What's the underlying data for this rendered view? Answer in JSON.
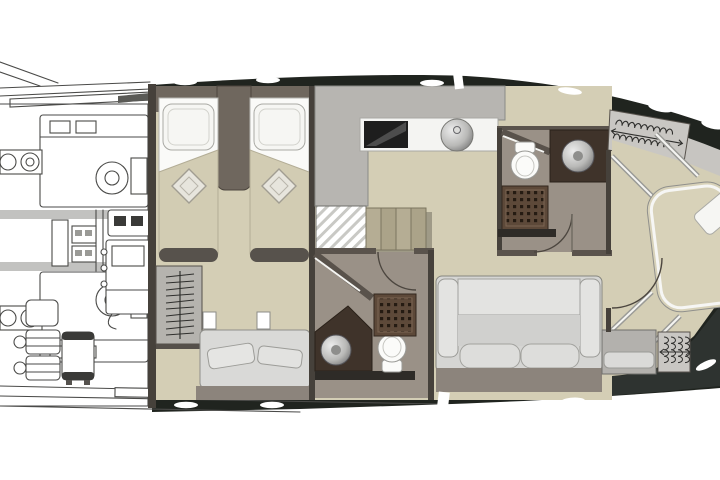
{
  "image_kind": "yacht-lower-deck-floor-plan",
  "visible_text": [],
  "colors": {
    "page_bg": "#ffffff",
    "hull_dark": "#20241f",
    "hull_bow": "#2e3330",
    "deck_gray": "#c7c5c1",
    "floor_beige": "#d4ceb5",
    "floor_bath": "#9a9187",
    "wall_dark": "#46413b",
    "wall_taupe": "#5a534c",
    "cabin_taupe": "#6f675e",
    "counter_gray": "#b7b5b1",
    "worktop_white": "#f4f4f2",
    "cooktop_black": "#1e1e1e",
    "vanity_brown": "#3f332a",
    "shower_brown": "#5d4939",
    "shower_dot": "#251b12",
    "blanket_beige": "#d2ccb3",
    "bed_frame_dark": "#57524c",
    "pillow_white": "#f6f6f3",
    "closet_gray": "#c9c7c3",
    "sofa_back": "#e3e3e1",
    "sofa_mid": "#d0d0ce",
    "sofa_seat": "#dddddb",
    "sofa_plinth": "#8c847c",
    "step_tan": "#b5ad94",
    "ink": "#4a4a48",
    "metal_light": "#ececec",
    "metal_dark": "#7e7e7e",
    "toilet_white": "#fbfbf9",
    "arc_ink": "#4c463f"
  },
  "rooms": [
    "engine-room",
    "twin-bed-cabin",
    "galley",
    "staircase",
    "mid-bathroom",
    "forward-bathroom",
    "salon-seating",
    "bow-cabin"
  ],
  "furniture_glyphs": [
    "engine-block",
    "generator",
    "battery-bank",
    "water-heater",
    "swim-platform",
    "twin-bed",
    "pillow",
    "diamond-cushion",
    "hanging-locker",
    "settee",
    "stairs",
    "cooktop",
    "round-sink",
    "toilet",
    "shower-grid",
    "sofa",
    "island-bed",
    "bench-seat",
    "door-swing",
    "cleat"
  ]
}
